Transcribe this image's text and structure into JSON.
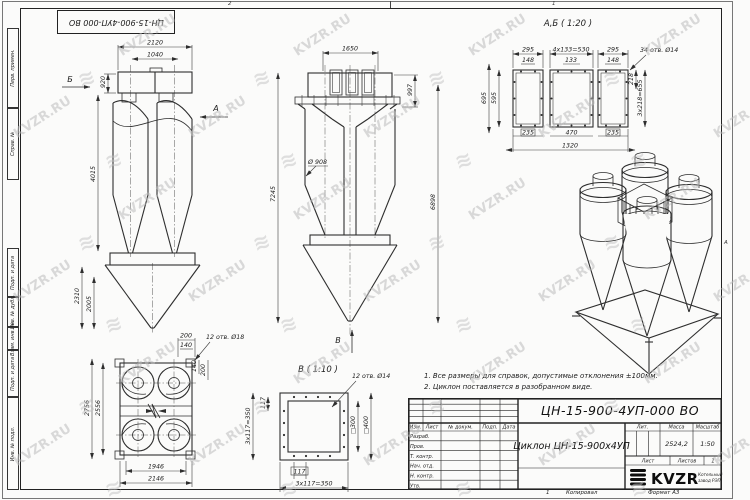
{
  "meta": {
    "doc_number": "ЦН-15-900-4УП-000 ВО"
  },
  "watermark": {
    "text": "KVZR.RU",
    "logo_glyph": "≋"
  },
  "frame": {
    "margin_labels": [
      "Перв. примен.",
      "Справ. №",
      "Подп. и дата",
      "Инв. № дубл.",
      "Взам. инв. №",
      "Подп. и дата",
      "Инв. № подл."
    ],
    "zone_top_left": "2",
    "zone_top_right": "1",
    "zone_right": "А",
    "zone_bottom": "1",
    "copied_label": "Копировал",
    "format_label": "Формат А3"
  },
  "notes": [
    "1. Все размеры для справок, допустимые отклонения ±100мм.",
    "2. Циклон поставляется в разобранном виде."
  ],
  "side_view": {
    "label_b": "Б",
    "label_a": "А",
    "dim_2120": "2120",
    "dim_1040": "1040",
    "dim_920": "920",
    "dim_4015": "4015",
    "dim_2310": "2310",
    "dim_2005": "2005"
  },
  "front_view": {
    "label_v": "В",
    "dim_1650": "1650",
    "dim_997": "997",
    "dim_7245": "7245",
    "dim_6898": "6898",
    "dim_d908": "Ø 908"
  },
  "flange_ab_view": {
    "title": "А,Б ( 1:20 )",
    "callout": "34 отв. Ø14",
    "dim_295_l": "295",
    "dim_530": "4x133=530",
    "dim_295_r": "295",
    "dim_148_l": "148",
    "dim_133": "133",
    "dim_148_r": "148",
    "dim_695": "695",
    "dim_595": "595",
    "dim_218": "218",
    "dim_655": "3x218=655",
    "dim_235_l": "235",
    "dim_470": "470",
    "dim_235_r": "235",
    "dim_1320": "1320"
  },
  "plan_view": {
    "callout": "12 отв. Ø18",
    "dim_200_t": "200",
    "dim_140_t": "140",
    "dim_140_r": "140",
    "dim_200_r": "200",
    "dim_2756": "2756",
    "dim_2556": "2556",
    "dim_1946": "1946",
    "dim_2146": "2146"
  },
  "flange_v_view": {
    "title": "В ( 1:10 )",
    "callout": "12 отв. Ø14",
    "dim_117_l": "117",
    "dim_350_l": "3x117=350",
    "dim_117_b": "117",
    "dim_350_b": "3x117=350",
    "dim_300": "□300",
    "dim_400": "□400"
  },
  "title_block": {
    "doc_number": "ЦН-15-900-4УП-000 ВО",
    "product_name": "Циклон ЦН-15-900х4УП",
    "col_izm": "Изм.",
    "col_list": "Лист",
    "col_doc": "№ докум.",
    "col_podp": "Подп.",
    "col_data": "Дата",
    "row_razrab": "Разраб.",
    "row_prov": "Пров.",
    "row_tkontr": "Т. контр.",
    "row_nachotd": "Нач. отд.",
    "row_nkontr": "Н. контр.",
    "row_utv": "Утв.",
    "lit_label": "Лит.",
    "mass_label": "Масса",
    "scale_label": "Масштаб",
    "mass_value": "2524,2",
    "scale_value": "1:50",
    "sheet_label": "Лист",
    "sheets_label": "Листов",
    "sheets_value": "1",
    "logo_text": "KVZR",
    "logo_sub1": "Котельный",
    "logo_sub2": "завод РЭП"
  }
}
